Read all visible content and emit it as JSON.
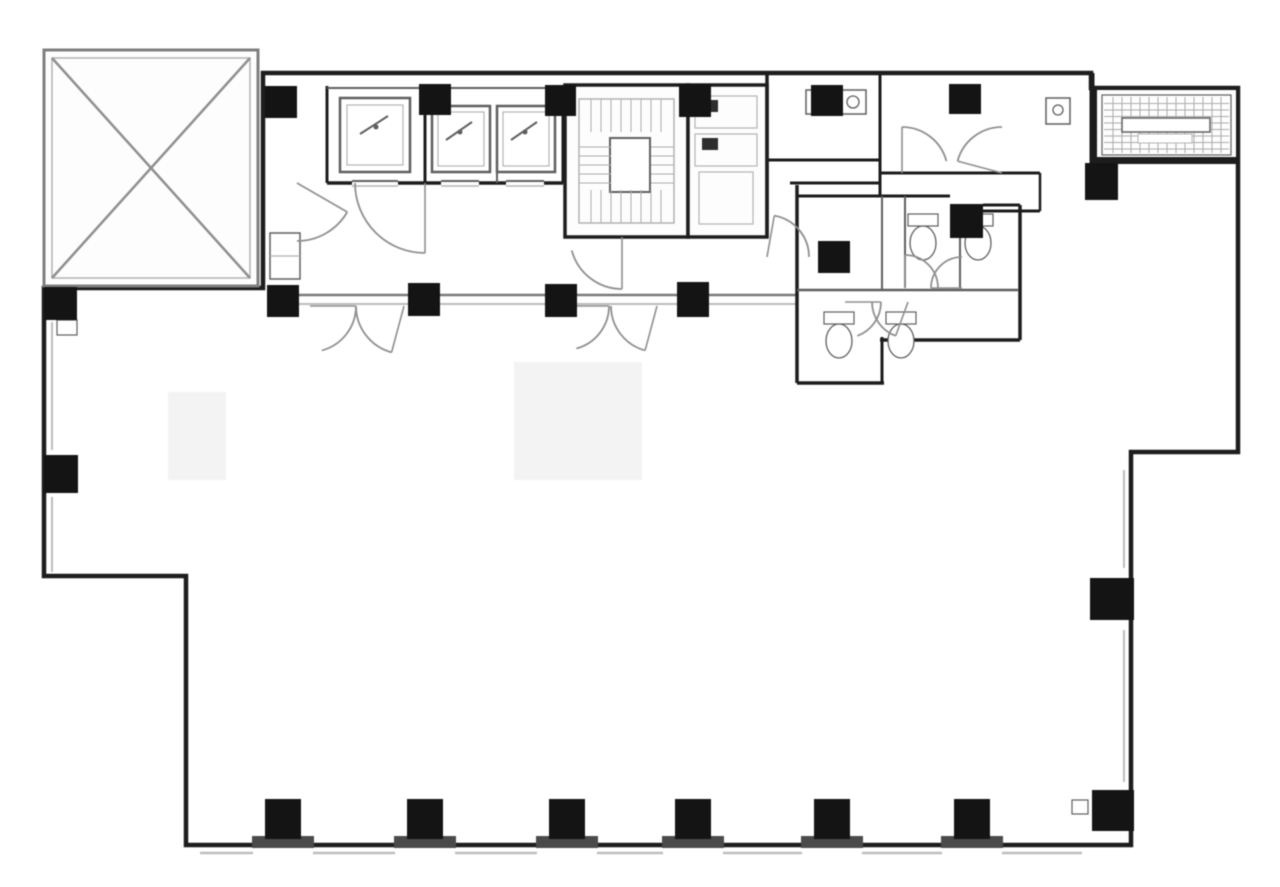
{
  "document": {
    "type": "architectural-floor-plan-scan",
    "canvas": {
      "w": 1280,
      "h": 887
    },
    "palette": {
      "d": "#1d1d1d",
      "m": "#5f5f5f",
      "l": "#b3b3b3",
      "paper": "#fdfdfd",
      "white": "#ffffff",
      "dark": "#2e2e2e",
      "col": "#141414",
      "plate": "#4a4a4a",
      "hatch": "#ababab",
      "arc": "#8f8f8f",
      "artifact": "#f3f3f3",
      "sill_d": "#7a7a7a",
      "sill_l": "#bdbdbd",
      "voidstroke": "#7f7f7f"
    }
  },
  "floorplan": {
    "outline": [
      [
        263,
        73
      ],
      [
        1091,
        73
      ],
      [
        1091,
        88
      ],
      [
        1238,
        88
      ],
      [
        1238,
        452
      ],
      [
        1131,
        452
      ],
      [
        1131,
        845
      ],
      [
        186,
        845
      ],
      [
        186,
        576
      ],
      [
        44,
        576
      ],
      [
        44,
        288
      ],
      [
        263,
        288
      ]
    ],
    "artifacts": [
      [
        168,
        392,
        58,
        88
      ],
      [
        514,
        362,
        128,
        118
      ]
    ],
    "void_square": {
      "outer": [
        44,
        50,
        214,
        236
      ],
      "inner": [
        52,
        58,
        198,
        220
      ],
      "diagonals": [
        [
          52,
          58,
          250,
          278
        ],
        [
          250,
          58,
          52,
          278
        ]
      ]
    },
    "sills": {
      "core_pairs": [
        [
          299,
          408
        ],
        [
          440,
          545
        ],
        [
          577,
          677
        ],
        [
          709,
          797
        ]
      ],
      "core_y1": 295,
      "core_y2": 304,
      "left_x": 52,
      "left_segs": [
        [
          322,
          450
        ],
        [
          497,
          572
        ]
      ],
      "bottom_y": 853,
      "bottom_segs": [
        [
          200,
          253
        ],
        [
          313,
          395
        ],
        [
          455,
          537
        ],
        [
          597,
          663
        ],
        [
          723,
          802
        ],
        [
          862,
          942
        ],
        [
          1002,
          1082
        ]
      ],
      "right_x": 1124,
      "right_segs": [
        [
          470,
          568
        ],
        [
          630,
          782
        ]
      ]
    },
    "walls": [
      [
        327,
        86,
        327,
        183,
        3,
        "d"
      ],
      [
        425,
        84,
        425,
        183,
        3,
        "d"
      ],
      [
        563,
        85,
        563,
        183,
        3,
        "d"
      ],
      [
        327,
        183,
        563,
        183,
        3.5,
        "d"
      ],
      [
        497,
        107,
        497,
        183,
        2,
        "m"
      ],
      [
        327,
        88,
        563,
        88,
        2,
        "m"
      ],
      [
        767,
        73,
        767,
        237,
        3.5,
        "d"
      ],
      [
        767,
        160,
        880,
        160,
        3,
        "d"
      ],
      [
        880,
        73,
        880,
        196,
        3,
        "d"
      ],
      [
        790,
        183,
        880,
        183,
        3,
        "d"
      ],
      [
        880,
        173,
        1040,
        173,
        3,
        "d"
      ],
      [
        1040,
        173,
        1040,
        211,
        2.5,
        "d"
      ],
      [
        983,
        211,
        1040,
        211,
        3,
        "d"
      ],
      [
        1092,
        73,
        1092,
        200,
        5,
        "d"
      ],
      [
        1095,
        160,
        1238,
        160,
        6,
        "d"
      ],
      [
        797,
        185,
        797,
        383,
        3.5,
        "d"
      ],
      [
        797,
        383,
        884,
        383,
        3.5,
        "d"
      ],
      [
        882,
        337,
        882,
        384,
        3,
        "d"
      ],
      [
        880,
        340,
        1020,
        340,
        3.5,
        "d"
      ],
      [
        1020,
        205,
        1020,
        340,
        3.5,
        "d"
      ],
      [
        983,
        205,
        1020,
        205,
        3,
        "d"
      ],
      [
        797,
        196,
        950,
        196,
        3,
        "d"
      ],
      [
        882,
        196,
        882,
        290,
        2,
        "m"
      ],
      [
        905,
        196,
        905,
        288,
        2,
        "m"
      ],
      [
        960,
        206,
        960,
        288,
        2,
        "m"
      ],
      [
        797,
        290,
        1018,
        290,
        2.5,
        "m"
      ]
    ],
    "rooms": [
      {
        "r": [
          565,
          85,
          123,
          152
        ],
        "sw": 3.5,
        "s": "d",
        "f": "paper",
        "name": "stair-room"
      },
      {
        "r": [
          579,
          99,
          95,
          124
        ],
        "sw": 1.5,
        "s": "l",
        "f": "none",
        "name": "stair-inner-wall"
      },
      {
        "r": [
          610,
          138,
          40,
          54
        ],
        "sw": 2,
        "s": "m",
        "f": "white",
        "name": "stair-landing"
      },
      {
        "r": [
          688,
          85,
          79,
          152
        ],
        "sw": 3.5,
        "s": "d",
        "f": "paper",
        "name": "pipe-shaft-room"
      },
      {
        "r": [
          695,
          96,
          62,
          32
        ],
        "sw": 1.2,
        "s": "l",
        "f": "none",
        "name": "shaft-compartment"
      },
      {
        "r": [
          695,
          134,
          62,
          32
        ],
        "sw": 1.2,
        "s": "l",
        "f": "none",
        "name": "shaft-compartment"
      },
      {
        "r": [
          699,
          172,
          54,
          52
        ],
        "sw": 1.2,
        "s": "l",
        "f": "none",
        "name": "shaft-compartment"
      },
      {
        "r": [
          702,
          100,
          16,
          12
        ],
        "sw": 0,
        "s": "none",
        "f": "dark",
        "name": "shaft-duct"
      },
      {
        "r": [
          702,
          138,
          16,
          12
        ],
        "sw": 0,
        "s": "none",
        "f": "dark",
        "name": "shaft-duct"
      },
      {
        "r": [
          1095,
          88,
          143,
          74
        ],
        "sw": 4,
        "s": "d",
        "f": "paper",
        "name": "machine-room"
      },
      {
        "r": [
          1102,
          95,
          129,
          60
        ],
        "sw": 1.2,
        "s": "m",
        "f": "none",
        "name": "machine-room-inner"
      },
      {
        "r": [
          340,
          98,
          70,
          74
        ],
        "sw": 2.5,
        "s": "m",
        "f": "white",
        "name": "elevator-car"
      },
      {
        "r": [
          347,
          105,
          56,
          60
        ],
        "sw": 1.2,
        "s": "l",
        "f": "none",
        "name": "elevator-car-inner"
      },
      {
        "r": [
          432,
          106,
          58,
          66
        ],
        "sw": 2.5,
        "s": "m",
        "f": "white",
        "name": "elevator-car"
      },
      {
        "r": [
          438,
          112,
          46,
          54
        ],
        "sw": 1.2,
        "s": "l",
        "f": "none",
        "name": "elevator-car-inner"
      },
      {
        "r": [
          497,
          106,
          58,
          66
        ],
        "sw": 2.5,
        "s": "m",
        "f": "white",
        "name": "elevator-car"
      },
      {
        "r": [
          503,
          112,
          46,
          54
        ],
        "sw": 1.2,
        "s": "l",
        "f": "none",
        "name": "elevator-car-inner"
      },
      {
        "r": [
          270,
          233,
          30,
          46
        ],
        "sw": 1.5,
        "s": "m",
        "f": "white",
        "name": "lobby-closet"
      },
      {
        "r": [
          806,
          90,
          26,
          24
        ],
        "sw": 1.5,
        "s": "m",
        "f": "white",
        "name": "sink-fixture"
      },
      {
        "r": [
          840,
          90,
          26,
          24
        ],
        "sw": 1.5,
        "s": "m",
        "f": "white",
        "name": "sink-fixture"
      },
      {
        "r": [
          1046,
          98,
          24,
          26
        ],
        "sw": 1.5,
        "s": "m",
        "f": "white",
        "name": "sink-fixture"
      },
      {
        "r": [
          908,
          214,
          30,
          12
        ],
        "sw": 1.2,
        "s": "m",
        "f": "white",
        "name": "toilet-tank"
      },
      {
        "r": [
          963,
          214,
          30,
          12
        ],
        "sw": 1.2,
        "s": "m",
        "f": "white",
        "name": "toilet-tank"
      },
      {
        "r": [
          824,
          312,
          30,
          12
        ],
        "sw": 1.2,
        "s": "m",
        "f": "white",
        "name": "toilet-tank"
      },
      {
        "r": [
          886,
          312,
          30,
          12
        ],
        "sw": 1.2,
        "s": "m",
        "f": "white",
        "name": "toilet-tank"
      }
    ],
    "hatches": [
      {
        "r": [
          581,
          99,
          84,
          33
        ],
        "dir": "v",
        "step": 10,
        "name": "stair-treads"
      },
      {
        "r": [
          581,
          190,
          84,
          33
        ],
        "dir": "v",
        "step": 10,
        "name": "stair-treads"
      },
      {
        "r": [
          579,
          138,
          32,
          50
        ],
        "dir": "h",
        "step": 9,
        "name": "stair-treads"
      },
      {
        "r": [
          651,
          138,
          23,
          50
        ],
        "dir": "h",
        "step": 9,
        "name": "stair-treads"
      },
      {
        "r": [
          1104,
          97,
          125,
          56
        ],
        "dir": "h",
        "step": 6.5,
        "name": "louvre-hatch"
      },
      {
        "r": [
          1104,
          97,
          125,
          56
        ],
        "dir": "v",
        "step": 9,
        "name": "louvre-hatch"
      }
    ],
    "overlay_rects": [
      {
        "r": [
          1122,
          118,
          88,
          14
        ],
        "sw": 1.5,
        "s": "m",
        "f": "white",
        "name": "machine-unit"
      },
      {
        "r": [
          1138,
          134,
          54,
          9
        ],
        "sw": 1,
        "s": "l",
        "f": "white",
        "name": "machine-unit"
      },
      {
        "r": [
          352,
          178,
          46,
          10
        ],
        "sw": 0,
        "s": "none",
        "f": "white",
        "name": "elevator-door-gap"
      },
      {
        "r": [
          441,
          178,
          38,
          10
        ],
        "sw": 0,
        "s": "none",
        "f": "white",
        "name": "elevator-door-gap"
      },
      {
        "r": [
          506,
          178,
          38,
          10
        ],
        "sw": 0,
        "s": "none",
        "f": "white",
        "name": "elevator-door-gap"
      },
      {
        "r": [
          57,
          320,
          20,
          15
        ],
        "sw": 1.2,
        "s": "m",
        "f": "white",
        "name": "wall-notch"
      },
      {
        "r": [
          1072,
          800,
          16,
          14
        ],
        "sw": 1.2,
        "s": "m",
        "f": "white",
        "name": "wall-notch"
      }
    ],
    "overlay_lines": [
      [
        352,
        181,
        398,
        181,
        2,
        "m"
      ],
      [
        441,
        181,
        479,
        181,
        2,
        "m"
      ],
      [
        506,
        181,
        544,
        181,
        2,
        "m"
      ],
      [
        352,
        186,
        398,
        186,
        1.5,
        "l"
      ],
      [
        441,
        186,
        479,
        186,
        1.5,
        "l"
      ],
      [
        506,
        186,
        544,
        186,
        1.5,
        "l"
      ],
      [
        360,
        134,
        388,
        116,
        2,
        "m"
      ],
      [
        446,
        140,
        472,
        122,
        2,
        "m"
      ],
      [
        511,
        140,
        537,
        122,
        2,
        "m"
      ],
      [
        270,
        256,
        300,
        256,
        1.2,
        "l"
      ]
    ],
    "circles": [
      {
        "c": [
          819,
          102,
          6
        ],
        "s": "m",
        "f": "none",
        "name": "sink-bowl"
      },
      {
        "c": [
          853,
          102,
          6
        ],
        "s": "m",
        "f": "none",
        "name": "sink-bowl"
      },
      {
        "c": [
          1058,
          110,
          5
        ],
        "s": "m",
        "f": "none",
        "name": "sink-bowl"
      },
      {
        "c": [
          376,
          127,
          2.5
        ],
        "s": "none",
        "f": "m",
        "name": "elevator-glyph-dot"
      },
      {
        "c": [
          460,
          132,
          2.5
        ],
        "s": "none",
        "f": "m",
        "name": "elevator-glyph-dot"
      },
      {
        "c": [
          525,
          132,
          2.5
        ],
        "s": "none",
        "f": "m",
        "name": "elevator-glyph-dot"
      }
    ],
    "ellipses": [
      {
        "e": [
          923,
          243,
          13,
          17
        ],
        "name": "toilet-bowl"
      },
      {
        "e": [
          978,
          243,
          13,
          17
        ],
        "name": "toilet-bowl"
      },
      {
        "e": [
          839,
          341,
          13,
          17
        ],
        "name": "toilet-bowl"
      },
      {
        "e": [
          901,
          341,
          13,
          17
        ],
        "name": "toilet-bowl"
      }
    ],
    "door_arcs": [
      [
        425,
        183,
        70,
        90,
        180
      ],
      [
        297,
        183,
        58,
        30,
        90
      ],
      [
        310,
        306,
        46,
        0,
        75
      ],
      [
        404,
        306,
        48,
        105,
        180
      ],
      [
        565,
        306,
        44,
        0,
        75
      ],
      [
        657,
        306,
        46,
        105,
        180
      ],
      [
        622,
        237,
        52,
        90,
        165
      ],
      [
        767,
        257,
        42,
        280,
        360
      ],
      [
        905,
        288,
        33,
        270,
        360
      ],
      [
        962,
        288,
        31,
        180,
        270
      ],
      [
        845,
        302,
        36,
        0,
        70
      ],
      [
        908,
        302,
        36,
        110,
        180
      ],
      [
        902,
        173,
        46,
        270,
        345
      ],
      [
        1002,
        173,
        46,
        195,
        270
      ]
    ],
    "columns": [
      [
        265,
        86,
        32,
        32
      ],
      [
        419,
        84,
        32,
        31
      ],
      [
        545,
        85,
        31,
        31
      ],
      [
        679,
        84,
        32,
        33
      ],
      [
        811,
        85,
        32,
        31
      ],
      [
        949,
        84,
        32,
        30
      ],
      [
        44,
        287,
        33,
        33
      ],
      [
        267,
        285,
        32,
        32
      ],
      [
        408,
        283,
        32,
        33
      ],
      [
        545,
        284,
        32,
        33
      ],
      [
        677,
        282,
        32,
        35
      ],
      [
        818,
        241,
        32,
        32
      ],
      [
        950,
        204,
        33,
        34
      ],
      [
        1085,
        163,
        33,
        37
      ],
      [
        44,
        455,
        34,
        38
      ],
      [
        1090,
        578,
        44,
        42
      ],
      [
        1092,
        790,
        42,
        41
      ],
      [
        265,
        799,
        36,
        40
      ],
      [
        407,
        799,
        36,
        40
      ],
      [
        549,
        799,
        36,
        40
      ],
      [
        675,
        799,
        36,
        40
      ],
      [
        814,
        799,
        36,
        40
      ],
      [
        954,
        799,
        36,
        40
      ]
    ],
    "column_bases": [
      [
        252,
        836,
        62,
        12
      ],
      [
        394,
        836,
        62,
        12
      ],
      [
        536,
        836,
        62,
        12
      ],
      [
        662,
        836,
        62,
        12
      ],
      [
        801,
        836,
        62,
        12
      ],
      [
        941,
        836,
        62,
        12
      ]
    ]
  }
}
